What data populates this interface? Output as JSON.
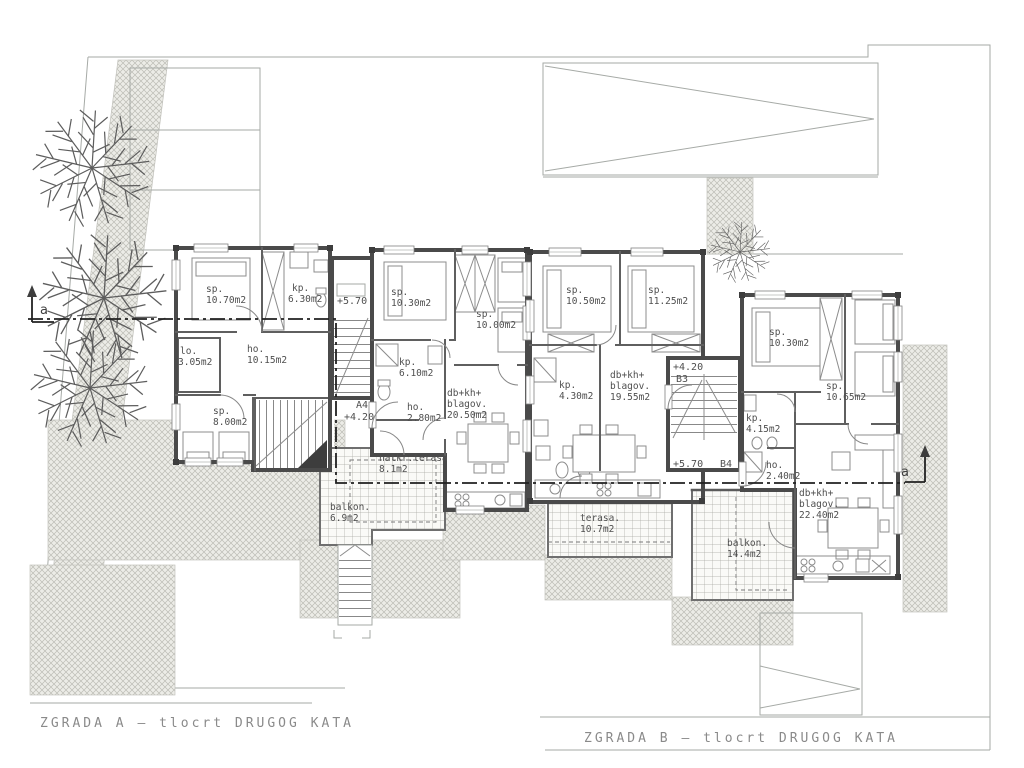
{
  "palette": {
    "wall": "#4a4a4a",
    "thin_line": "#a6aaa6",
    "hatch_line": "#bcbcb5",
    "hatch_bg": "#ecece7",
    "tile_bg": "#fafaf7",
    "text": "#4f4f4f",
    "caption": "#8a8a8a",
    "section_line": "#202020",
    "furniture": "#8c8c8c"
  },
  "captions": {
    "building_a": "ZGRADA A – tlocrt DRUGOG KATA",
    "building_b": "ZGRADA B – tlocrt DRUGOG KATA"
  },
  "section_markers": {
    "left": "a",
    "right": "a"
  },
  "stair_a": {
    "level_top": "+5.70",
    "unit_label": "A4",
    "level_landing": "+4.20"
  },
  "stair_b": {
    "level_top": "+4.20",
    "unit_top_label": "B3",
    "level_bottom": "+5.70",
    "unit_bottom_label": "B4"
  },
  "unit_a3": {
    "rooms": [
      {
        "n": "sp.",
        "a": "10.70m2"
      },
      {
        "n": "kp.",
        "a": "6.30m2"
      },
      {
        "n": "lo.",
        "a": "3.05m2"
      },
      {
        "n": "ho.",
        "a": "10.15m2"
      },
      {
        "n": "sp.",
        "a": "8.00m2"
      }
    ]
  },
  "unit_a4": {
    "rooms": [
      {
        "n": "sp.",
        "a": "10.30m2"
      },
      {
        "n": "sp.",
        "a": "10.00m2"
      },
      {
        "n": "kp.",
        "a": "6.10m2"
      },
      {
        "n": "ho.",
        "a": "2.80m2"
      }
    ],
    "living": {
      "l1": "db+kh+",
      "l2": "blagov.",
      "a": "20.50m2"
    },
    "covered_terrace": {
      "n": "natkr.terasa",
      "a": "8.1m2"
    },
    "balcony": {
      "n": "balkon.",
      "a": "6.9m2"
    }
  },
  "unit_b3": {
    "rooms": [
      {
        "n": "sp.",
        "a": "10.50m2"
      },
      {
        "n": "sp.",
        "a": "11.25m2"
      },
      {
        "n": "kp.",
        "a": "4.30m2"
      }
    ],
    "living": {
      "l1": "db+kh+",
      "l2": "blagov.",
      "a": "19.55m2"
    },
    "terrace": {
      "n": "terasa.",
      "a": "10.7m2"
    }
  },
  "unit_b4": {
    "rooms": [
      {
        "n": "sp.",
        "a": "10.30m2"
      },
      {
        "n": "sp.",
        "a": "10.65m2"
      },
      {
        "n": "kp.",
        "a": "4.15m2"
      },
      {
        "n": "ho.",
        "a": "2.40m2"
      }
    ],
    "living": {
      "l1": "db+kh+",
      "l2": "blagov.",
      "a": "22.40m2"
    },
    "balcony": {
      "n": "balkon.",
      "a": "14.4m2"
    }
  }
}
